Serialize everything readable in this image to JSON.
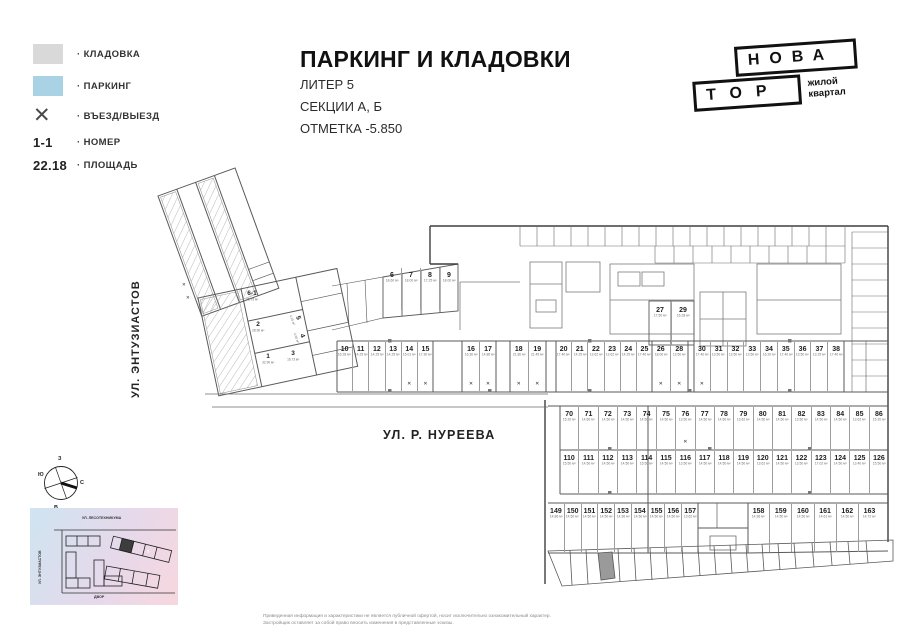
{
  "legend": {
    "storage_label": "· КЛАДОВКА",
    "parking_label": "· ПАРКИНГ",
    "entry_label": "· ВЪЕЗД/ВЫЕЗД",
    "number_example": "1-1",
    "number_label": "· НОМЕР",
    "area_example": "22.18",
    "area_label": "· ПЛОЩАДЬ"
  },
  "symbols": {
    "x": "✕"
  },
  "title": {
    "main": "ПАРКИНГ И КЛАДОВКИ",
    "line1": "ЛИТЕР 5",
    "line2": "СЕКЦИИ А, Б",
    "line3": "ОТМЕТКА -5.850"
  },
  "logo": {
    "top": "НОВА",
    "bottom": "ТОР",
    "tagline1": "жилой",
    "tagline2": "квартал"
  },
  "streets": {
    "left": "УЛ. ЭНТУЗИАСТОВ",
    "main": "УЛ. Р. НУРЕЕВА"
  },
  "compass": {
    "north": "С",
    "south": "Ю",
    "west": "З",
    "east": "В"
  },
  "minimap": {
    "street_top": "УЛ. ЛЕСОТЕХНИКУМА",
    "street_left": "УЛ. ЭНТУЗИАСТОВ",
    "yard": "ДВОР",
    "highlight": "5"
  },
  "disclaimer": {
    "line1": "Приведенная информация и характеристики не является публичной офертой, носит исключительно ознакомительный характер.",
    "line2": "Застройщик оставляет за собой право вносить изменения в представленные эскизы."
  },
  "colors": {
    "storage": "#d9d9d9",
    "parking": "#a9d3e5",
    "line": "#555555"
  },
  "plan": {
    "wing_rooms": [
      {
        "num": "6-1",
        "area": "45.75 м²"
      },
      {
        "num": "2",
        "area": "28.90 м²"
      },
      {
        "num": "1",
        "area": "32.90 м²"
      },
      {
        "num": "5",
        "area": "4.15 м²"
      },
      {
        "num": "4",
        "area": "4.60 м²"
      },
      {
        "num": "3",
        "area": "16.73 м²"
      }
    ],
    "row_6_9": [
      {
        "num": "6",
        "area": "18.60 м²",
        "mark": ""
      },
      {
        "num": "7",
        "area": "18.00 м²",
        "mark": ""
      },
      {
        "num": "8",
        "area": "17.25 м²",
        "mark": ""
      },
      {
        "num": "9",
        "area": "18.00 м²",
        "mark": ""
      }
    ],
    "row_10_15": [
      {
        "num": "10",
        "area": "16.28 м²",
        "mark": ""
      },
      {
        "num": "11",
        "area": "14.25 м²",
        "mark": ""
      },
      {
        "num": "12",
        "area": "14.25 м²",
        "mark": ""
      },
      {
        "num": "13",
        "area": "14.25 м²",
        "mark": ""
      },
      {
        "num": "14",
        "area": "15.01 м²",
        "mark": "✕"
      },
      {
        "num": "15",
        "area": "17.30 м²",
        "mark": "✕"
      }
    ],
    "row_16_17": [
      {
        "num": "16",
        "area": "16.30 м²",
        "mark": "✕"
      },
      {
        "num": "17",
        "area": "14.86 м²",
        "mark": "✕"
      }
    ],
    "row_18_19": [
      {
        "num": "18",
        "area": "21.80 м²",
        "mark": "✕"
      },
      {
        "num": "19",
        "area": "21.45 м²",
        "mark": "✕"
      }
    ],
    "row_20_25": [
      {
        "num": "20",
        "area": "17.40 м²",
        "mark": ""
      },
      {
        "num": "21",
        "area": "14.25 м²",
        "mark": ""
      },
      {
        "num": "22",
        "area": "13.62 м²",
        "mark": ""
      },
      {
        "num": "23",
        "area": "13.62 м²",
        "mark": ""
      },
      {
        "num": "24",
        "area": "14.25 м²",
        "mark": ""
      },
      {
        "num": "25",
        "area": "17.40 м²",
        "mark": ""
      }
    ],
    "row_26_28": [
      {
        "num": "26",
        "area": "18.00 м²",
        "mark": "✕"
      },
      {
        "num": "28",
        "area": "13.50 м²",
        "mark": "✕"
      }
    ],
    "row_27_29": [
      {
        "num": "27",
        "area": "17.50 м²",
        "mark": ""
      },
      {
        "num": "29",
        "area": "16.28 м²",
        "mark": ""
      }
    ],
    "row_30_38": [
      {
        "num": "30",
        "area": "17.40 м²",
        "mark": "✕"
      },
      {
        "num": "31",
        "area": "13.50 м²",
        "mark": ""
      },
      {
        "num": "32",
        "area": "13.50 м²",
        "mark": ""
      },
      {
        "num": "33",
        "area": "13.50 м²",
        "mark": ""
      },
      {
        "num": "34",
        "area": "16.20 м²",
        "mark": ""
      },
      {
        "num": "35",
        "area": "17.40 м²",
        "mark": ""
      },
      {
        "num": "36",
        "area": "13.50 м²",
        "mark": ""
      },
      {
        "num": "37",
        "area": "13.25 м²",
        "mark": ""
      },
      {
        "num": "38",
        "area": "17.40 м²",
        "mark": ""
      }
    ],
    "row_70_86": [
      {
        "num": "70",
        "area": "15.20 м²",
        "mark": ""
      },
      {
        "num": "71",
        "area": "14.50 м²",
        "mark": ""
      },
      {
        "num": "72",
        "area": "14.50 м²",
        "mark": ""
      },
      {
        "num": "73",
        "area": "14.50 м²",
        "mark": ""
      },
      {
        "num": "74",
        "area": "14.50 м²",
        "mark": ""
      },
      {
        "num": "75",
        "area": "14.50 м²",
        "mark": ""
      },
      {
        "num": "76",
        "area": "13.50 м²",
        "mark": "✕"
      },
      {
        "num": "77",
        "area": "14.50 м²",
        "mark": ""
      },
      {
        "num": "78",
        "area": "14.50 м²",
        "mark": ""
      },
      {
        "num": "79",
        "area": "13.62 м²",
        "mark": ""
      },
      {
        "num": "80",
        "area": "14.50 м²",
        "mark": ""
      },
      {
        "num": "81",
        "area": "14.50 м²",
        "mark": ""
      },
      {
        "num": "82",
        "area": "13.50 м²",
        "mark": ""
      },
      {
        "num": "83",
        "area": "14.50 м²",
        "mark": ""
      },
      {
        "num": "84",
        "area": "14.50 м²",
        "mark": ""
      },
      {
        "num": "85",
        "area": "13.62 м²",
        "mark": ""
      },
      {
        "num": "86",
        "area": "15.20 м²",
        "mark": ""
      }
    ],
    "row_110_126": [
      {
        "num": "110",
        "area": "15.50 м²",
        "mark": ""
      },
      {
        "num": "111",
        "area": "14.50 м²",
        "mark": ""
      },
      {
        "num": "112",
        "area": "14.50 м²",
        "mark": ""
      },
      {
        "num": "113",
        "area": "14.50 м²",
        "mark": ""
      },
      {
        "num": "114",
        "area": "15.50 м²",
        "mark": ""
      },
      {
        "num": "115",
        "area": "14.50 м²",
        "mark": ""
      },
      {
        "num": "116",
        "area": "13.50 м²",
        "mark": ""
      },
      {
        "num": "117",
        "area": "14.50 м²",
        "mark": ""
      },
      {
        "num": "118",
        "area": "14.50 м²",
        "mark": ""
      },
      {
        "num": "119",
        "area": "14.50 м²",
        "mark": ""
      },
      {
        "num": "120",
        "area": "13.62 м²",
        "mark": ""
      },
      {
        "num": "121",
        "area": "14.50 м²",
        "mark": ""
      },
      {
        "num": "122",
        "area": "13.50 м²",
        "mark": ""
      },
      {
        "num": "123",
        "area": "17.02 м²",
        "mark": ""
      },
      {
        "num": "124",
        "area": "14.50 м²",
        "mark": ""
      },
      {
        "num": "125",
        "area": "13.40 м²",
        "mark": ""
      },
      {
        "num": "126",
        "area": "15.50 м²",
        "mark": ""
      }
    ],
    "row_149_157": [
      {
        "num": "149",
        "area": "14.86 м²",
        "mark": ""
      },
      {
        "num": "150",
        "area": "14.50 м²",
        "mark": ""
      },
      {
        "num": "151",
        "area": "14.50 м²",
        "mark": ""
      },
      {
        "num": "152",
        "area": "14.50 м²",
        "mark": ""
      },
      {
        "num": "153",
        "area": "14.36 м²",
        "mark": ""
      },
      {
        "num": "154",
        "area": "14.50 м²",
        "mark": ""
      },
      {
        "num": "155",
        "area": "14.50 м²",
        "mark": ""
      },
      {
        "num": "156",
        "area": "14.50 м²",
        "mark": ""
      },
      {
        "num": "157",
        "area": "13.62 м²",
        "mark": ""
      }
    ],
    "row_158_163": [
      {
        "num": "158",
        "area": "14.36 м²",
        "mark": ""
      },
      {
        "num": "159",
        "area": "14.50 м²",
        "mark": ""
      },
      {
        "num": "160",
        "area": "14.50 м²",
        "mark": ""
      },
      {
        "num": "161",
        "area": "14.61 м²",
        "mark": ""
      },
      {
        "num": "162",
        "area": "14.50 м²",
        "mark": ""
      },
      {
        "num": "163",
        "area": "14.72 м²",
        "mark": ""
      }
    ]
  }
}
